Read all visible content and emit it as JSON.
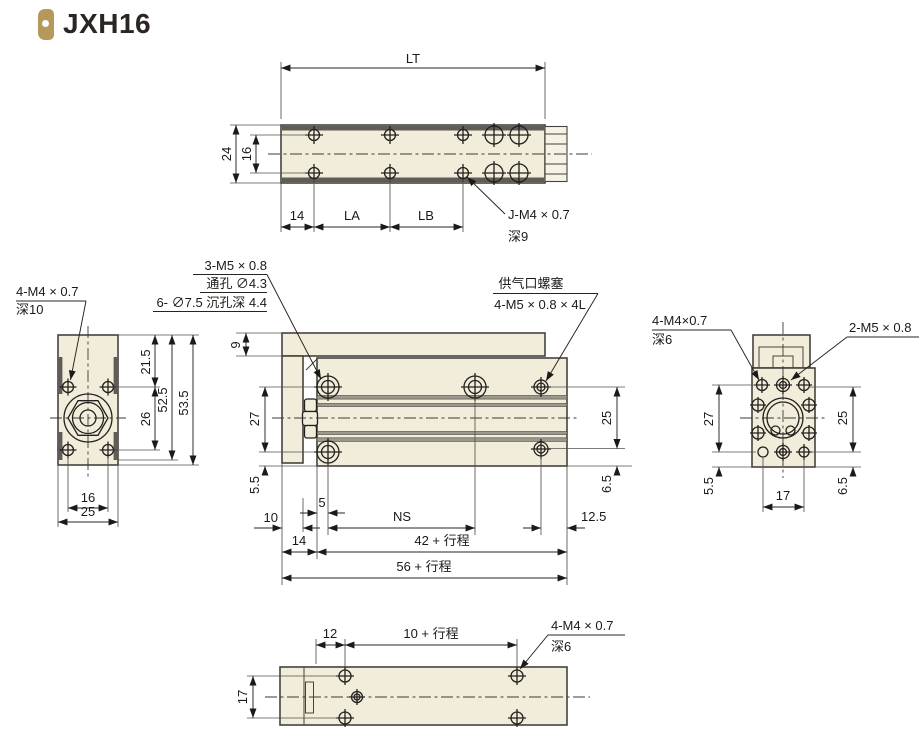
{
  "title": {
    "text": "JXH16"
  },
  "colors": {
    "body_fill": "#f2edda",
    "line": "#45433e",
    "accent_gold": "#b5985a"
  },
  "top_view": {
    "lt": "LT",
    "d24": "24",
    "d16": "16",
    "d14": "14",
    "la": "LA",
    "lb": "LB",
    "note_line1": "J-M4 × 0.7",
    "note_line2": "深9"
  },
  "left_view": {
    "note_line1": "4-M4 × 0.7",
    "note_line2": "深10",
    "d215": "21.5",
    "d525": "52.5",
    "d535": "53.5",
    "d26": "26",
    "d16": "16",
    "d25": "25"
  },
  "front_view": {
    "cb_note1": "3-M5 × 0.8",
    "cb_note2": "通孔 ∅4.3",
    "cb_note3": "6- ∅7.5 沉孔深 4.4",
    "port_note1": "供气口螺塞",
    "port_note2": "4-M5 × 0.8 × 4L",
    "d9": "9",
    "d27": "27",
    "d55": "5.5",
    "d25": "25",
    "d65": "6.5",
    "d10": "10",
    "d5": "5",
    "ns": "NS",
    "d125": "12.5",
    "d14": "14",
    "d42": "42 + 行程",
    "d56": "56 + 行程"
  },
  "right_view": {
    "note1_line1": "4-M4×0.7",
    "note1_line2": "深6",
    "note2": "2-M5 × 0.8",
    "d27": "27",
    "d25": "25",
    "d55": "5.5",
    "d65": "6.5",
    "d17": "17"
  },
  "bottom_view": {
    "d12": "12",
    "d10s": "10 + 行程",
    "note_line1": "4-M4 × 0.7",
    "note_line2": "深6",
    "d17": "17"
  }
}
